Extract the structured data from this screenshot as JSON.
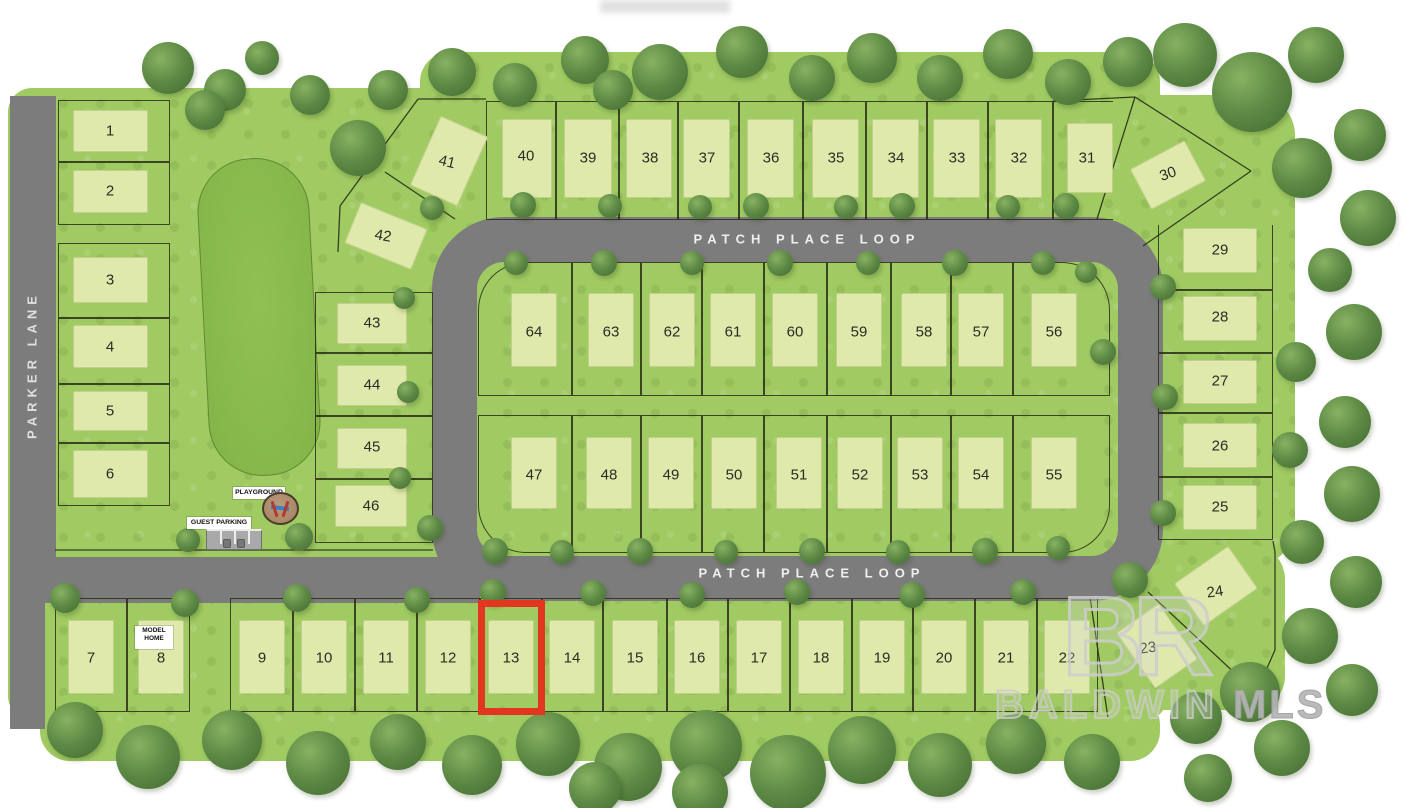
{
  "map": {
    "streets": {
      "vertical": "PARKER LANE",
      "loop_top": "PATCH PLACE LOOP",
      "loop_bottom": "PATCH PLACE LOOP"
    },
    "labels": {
      "model_home": "MODEL HOME",
      "playground": "PLAYGROUND",
      "guest_parking": "GUEST PARKING"
    },
    "watermark": {
      "logo": "BR",
      "name": "BALDWIN",
      "suffix": "MLS"
    },
    "highlight": {
      "lot": "13",
      "rect": [
        478,
        600,
        67,
        115
      ],
      "color": "#e23620"
    },
    "colors": {
      "grass": "#a0ca62",
      "pad": "#dfe9ab",
      "road": "#7c7c7c",
      "pond": "#87b84b",
      "tree": "#5d8a45",
      "highlight_red": "#e23620",
      "watermark_gray": "#cdcdcd"
    },
    "lots": [
      {
        "n": "1",
        "r": [
          58,
          100,
          112,
          62
        ],
        "pad": [
          73,
          110,
          75,
          42
        ],
        "num": [
          110,
          131
        ]
      },
      {
        "n": "2",
        "r": [
          58,
          162,
          112,
          63
        ],
        "pad": [
          73,
          170,
          75,
          43
        ],
        "num": [
          110,
          191
        ]
      },
      {
        "n": "3",
        "r": [
          58,
          243,
          112,
          75
        ],
        "pad": [
          73,
          257,
          75,
          46
        ],
        "num": [
          110,
          280
        ]
      },
      {
        "n": "4",
        "r": [
          58,
          318,
          112,
          66
        ],
        "pad": [
          73,
          325,
          75,
          43
        ],
        "num": [
          110,
          347
        ]
      },
      {
        "n": "5",
        "r": [
          58,
          384,
          112,
          59
        ],
        "pad": [
          73,
          391,
          75,
          40
        ],
        "num": [
          110,
          411
        ]
      },
      {
        "n": "6",
        "r": [
          58,
          443,
          112,
          63
        ],
        "pad": [
          73,
          450,
          75,
          48
        ],
        "num": [
          110,
          474
        ]
      },
      {
        "n": "7",
        "r": [
          55,
          598,
          72,
          114
        ],
        "pad": [
          68,
          620,
          46,
          74
        ],
        "num": [
          91,
          658
        ]
      },
      {
        "n": "8",
        "r": [
          127,
          598,
          63,
          114
        ],
        "pad": [
          138,
          620,
          46,
          74
        ],
        "num": [
          161,
          658
        ]
      },
      {
        "n": "9",
        "r": [
          230,
          598,
          63,
          114
        ],
        "pad": [
          239,
          620,
          46,
          74
        ],
        "num": [
          262,
          658
        ]
      },
      {
        "n": "10",
        "r": [
          293,
          598,
          62,
          114
        ],
        "pad": [
          301,
          620,
          46,
          74
        ],
        "num": [
          324,
          658
        ]
      },
      {
        "n": "11",
        "r": [
          355,
          598,
          62,
          114
        ],
        "pad": [
          363,
          620,
          46,
          74
        ],
        "num": [
          386,
          658
        ]
      },
      {
        "n": "12",
        "r": [
          417,
          598,
          63,
          114
        ],
        "pad": [
          425,
          620,
          46,
          74
        ],
        "num": [
          448,
          658
        ]
      },
      {
        "n": "13",
        "r": [
          480,
          598,
          62,
          114
        ],
        "pad": [
          488,
          620,
          46,
          74
        ],
        "num": [
          511,
          658
        ]
      },
      {
        "n": "14",
        "r": [
          542,
          598,
          61,
          114
        ],
        "pad": [
          549,
          620,
          46,
          74
        ],
        "num": [
          572,
          658
        ]
      },
      {
        "n": "15",
        "r": [
          603,
          598,
          64,
          114
        ],
        "pad": [
          612,
          620,
          46,
          74
        ],
        "num": [
          635,
          658
        ]
      },
      {
        "n": "16",
        "r": [
          667,
          598,
          61,
          114
        ],
        "pad": [
          674,
          620,
          46,
          74
        ],
        "num": [
          697,
          658
        ]
      },
      {
        "n": "17",
        "r": [
          728,
          598,
          62,
          114
        ],
        "pad": [
          736,
          620,
          46,
          74
        ],
        "num": [
          759,
          658
        ]
      },
      {
        "n": "18",
        "r": [
          790,
          598,
          62,
          114
        ],
        "pad": [
          798,
          620,
          46,
          74
        ],
        "num": [
          821,
          658
        ]
      },
      {
        "n": "19",
        "r": [
          852,
          598,
          61,
          114
        ],
        "pad": [
          859,
          620,
          46,
          74
        ],
        "num": [
          882,
          658
        ]
      },
      {
        "n": "20",
        "r": [
          913,
          598,
          62,
          114
        ],
        "pad": [
          921,
          620,
          46,
          74
        ],
        "num": [
          944,
          658
        ]
      },
      {
        "n": "21",
        "r": [
          975,
          598,
          62,
          114
        ],
        "pad": [
          983,
          620,
          46,
          74
        ],
        "num": [
          1006,
          658
        ]
      },
      {
        "n": "22",
        "r": [
          1037,
          598,
          61,
          114
        ],
        "pad": [
          1044,
          620,
          46,
          74
        ],
        "num": [
          1067,
          658
        ]
      },
      {
        "n": "23",
        "pad": [
          1131,
          612,
          52,
          68
        ],
        "prot": -35,
        "num": [
          1148,
          648
        ],
        "nrot": -8
      },
      {
        "n": "24",
        "pad": [
          1183,
          560,
          66,
          52
        ],
        "prot": -35,
        "num": [
          1215,
          592
        ],
        "nrot": -8
      },
      {
        "n": "25",
        "r": [
          1158,
          477,
          115,
          63
        ],
        "pad": [
          1183,
          485,
          74,
          45
        ],
        "num": [
          1220,
          507
        ]
      },
      {
        "n": "26",
        "r": [
          1158,
          413,
          115,
          64
        ],
        "pad": [
          1183,
          423,
          74,
          45
        ],
        "num": [
          1220,
          446
        ]
      },
      {
        "n": "27",
        "r": [
          1158,
          353,
          115,
          60
        ],
        "pad": [
          1183,
          360,
          74,
          44
        ],
        "num": [
          1220,
          381
        ]
      },
      {
        "n": "28",
        "r": [
          1158,
          290,
          115,
          63
        ],
        "pad": [
          1183,
          296,
          74,
          45
        ],
        "num": [
          1220,
          317
        ]
      },
      {
        "n": "29",
        "r": [
          1158,
          225,
          115,
          65
        ],
        "sides": "no-top",
        "pad": [
          1183,
          228,
          74,
          45
        ],
        "num": [
          1220,
          250
        ]
      },
      {
        "n": "30",
        "pad": [
          1137,
          152,
          62,
          46
        ],
        "prot": -28,
        "num": [
          1168,
          174
        ],
        "nrot": -20
      },
      {
        "n": "31",
        "r": [
          1053,
          101,
          60,
          119
        ],
        "sides": "no-right",
        "pad": [
          1067,
          123,
          46,
          70
        ],
        "num": [
          1087,
          158
        ]
      },
      {
        "n": "32",
        "r": [
          988,
          101,
          65,
          119
        ],
        "pad": [
          995,
          119,
          47,
          79
        ],
        "num": [
          1019,
          158
        ]
      },
      {
        "n": "33",
        "r": [
          927,
          101,
          61,
          119
        ],
        "pad": [
          933,
          119,
          47,
          79
        ],
        "num": [
          957,
          158
        ]
      },
      {
        "n": "34",
        "r": [
          866,
          101,
          61,
          119
        ],
        "pad": [
          872,
          119,
          47,
          79
        ],
        "num": [
          896,
          158
        ]
      },
      {
        "n": "35",
        "r": [
          803,
          101,
          63,
          119
        ],
        "pad": [
          812,
          119,
          47,
          79
        ],
        "num": [
          836,
          158
        ]
      },
      {
        "n": "36",
        "r": [
          739,
          101,
          64,
          119
        ],
        "pad": [
          747,
          119,
          47,
          79
        ],
        "num": [
          771,
          158
        ]
      },
      {
        "n": "37",
        "r": [
          678,
          101,
          61,
          119
        ],
        "pad": [
          683,
          119,
          47,
          79
        ],
        "num": [
          707,
          158
        ]
      },
      {
        "n": "38",
        "r": [
          619,
          101,
          59,
          119
        ],
        "pad": [
          626,
          119,
          46,
          79
        ],
        "num": [
          650,
          158
        ]
      },
      {
        "n": "39",
        "r": [
          556,
          101,
          63,
          119
        ],
        "pad": [
          564,
          119,
          48,
          79
        ],
        "num": [
          588,
          158
        ]
      },
      {
        "n": "40",
        "r": [
          486,
          101,
          70,
          119
        ],
        "pad": [
          502,
          119,
          50,
          79
        ],
        "num": [
          526,
          156
        ]
      },
      {
        "n": "41",
        "pad": [
          423,
          123,
          52,
          76
        ],
        "prot": 24,
        "num": [
          447,
          162
        ],
        "nrot": 14
      },
      {
        "n": "42",
        "pad": [
          350,
          214,
          72,
          44
        ],
        "prot": 22,
        "num": [
          383,
          236
        ],
        "nrot": 10
      },
      {
        "n": "43",
        "r": [
          315,
          292,
          118,
          61
        ],
        "pad": [
          337,
          303,
          70,
          41
        ],
        "num": [
          372,
          323
        ]
      },
      {
        "n": "44",
        "r": [
          315,
          353,
          118,
          63
        ],
        "pad": [
          337,
          365,
          70,
          41
        ],
        "num": [
          372,
          385
        ]
      },
      {
        "n": "45",
        "r": [
          315,
          416,
          118,
          63
        ],
        "pad": [
          337,
          428,
          70,
          41
        ],
        "num": [
          372,
          447
        ]
      },
      {
        "n": "46",
        "r": [
          315,
          479,
          118,
          64
        ],
        "pad": [
          335,
          485,
          72,
          42
        ],
        "num": [
          371,
          506
        ]
      },
      {
        "n": "47",
        "r": [
          478,
          415,
          94,
          138
        ],
        "corner": "bl",
        "pad": [
          511,
          437,
          46,
          72
        ],
        "num": [
          534,
          475
        ]
      },
      {
        "n": "48",
        "r": [
          572,
          415,
          69,
          138
        ],
        "pad": [
          586,
          437,
          46,
          72
        ],
        "num": [
          609,
          475
        ]
      },
      {
        "n": "49",
        "r": [
          641,
          415,
          61,
          138
        ],
        "pad": [
          648,
          437,
          46,
          72
        ],
        "num": [
          671,
          475
        ]
      },
      {
        "n": "50",
        "r": [
          702,
          415,
          62,
          138
        ],
        "pad": [
          711,
          437,
          46,
          72
        ],
        "num": [
          734,
          475
        ]
      },
      {
        "n": "51",
        "r": [
          764,
          415,
          63,
          138
        ],
        "pad": [
          776,
          437,
          46,
          72
        ],
        "num": [
          799,
          475
        ]
      },
      {
        "n": "52",
        "r": [
          827,
          415,
          64,
          138
        ],
        "pad": [
          837,
          437,
          46,
          72
        ],
        "num": [
          860,
          475
        ]
      },
      {
        "n": "53",
        "r": [
          891,
          415,
          60,
          138
        ],
        "pad": [
          897,
          437,
          46,
          72
        ],
        "num": [
          920,
          475
        ]
      },
      {
        "n": "54",
        "r": [
          951,
          415,
          62,
          138
        ],
        "pad": [
          958,
          437,
          46,
          72
        ],
        "num": [
          981,
          475
        ]
      },
      {
        "n": "55",
        "r": [
          1013,
          415,
          97,
          138
        ],
        "corner": "br",
        "pad": [
          1031,
          437,
          46,
          72
        ],
        "num": [
          1054,
          475
        ]
      },
      {
        "n": "56",
        "r": [
          1013,
          262,
          97,
          134
        ],
        "corner": "tr",
        "pad": [
          1031,
          293,
          46,
          74
        ],
        "num": [
          1054,
          332
        ]
      },
      {
        "n": "57",
        "r": [
          951,
          262,
          62,
          134
        ],
        "pad": [
          958,
          293,
          46,
          74
        ],
        "num": [
          981,
          332
        ]
      },
      {
        "n": "58",
        "r": [
          891,
          262,
          60,
          134
        ],
        "pad": [
          901,
          293,
          46,
          74
        ],
        "num": [
          924,
          332
        ]
      },
      {
        "n": "59",
        "r": [
          827,
          262,
          64,
          134
        ],
        "pad": [
          836,
          293,
          46,
          74
        ],
        "num": [
          859,
          332
        ]
      },
      {
        "n": "60",
        "r": [
          764,
          262,
          63,
          134
        ],
        "pad": [
          772,
          293,
          46,
          74
        ],
        "num": [
          795,
          332
        ]
      },
      {
        "n": "61",
        "r": [
          702,
          262,
          62,
          134
        ],
        "pad": [
          710,
          293,
          46,
          74
        ],
        "num": [
          733,
          332
        ]
      },
      {
        "n": "62",
        "r": [
          641,
          262,
          61,
          134
        ],
        "pad": [
          649,
          293,
          46,
          74
        ],
        "num": [
          672,
          332
        ]
      },
      {
        "n": "63",
        "r": [
          572,
          262,
          69,
          134
        ],
        "pad": [
          588,
          293,
          46,
          74
        ],
        "num": [
          611,
          332
        ]
      },
      {
        "n": "64",
        "r": [
          478,
          262,
          94,
          134
        ],
        "corner": "tl",
        "pad": [
          511,
          293,
          46,
          74
        ],
        "num": [
          534,
          332
        ]
      }
    ]
  }
}
